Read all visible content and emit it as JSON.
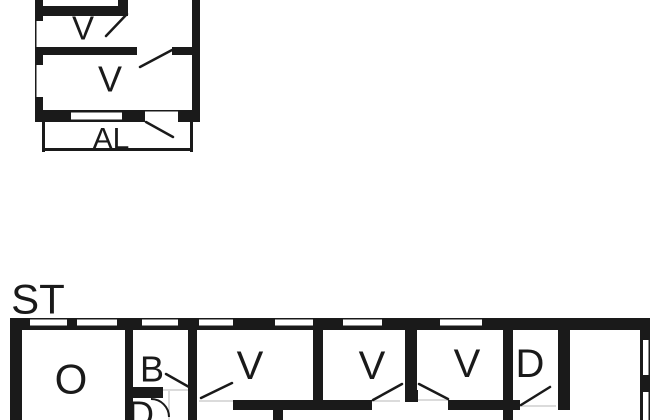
{
  "page": {
    "background": "#ffffff"
  },
  "floor_plan": {
    "type": "floor-plan",
    "canvas": {
      "width": 650,
      "height": 420
    },
    "colors": {
      "wall": "#1a1a1a",
      "floor": "#ffffff",
      "door_leaf": "#1a1a1a",
      "threshold": "#cfcfcf"
    },
    "buildings": [
      {
        "name": "upper-building",
        "room_labels": [
          "V",
          "V",
          "AL"
        ]
      },
      {
        "name": "lower-building",
        "annotation": "ST",
        "room_labels": [
          "O",
          "B",
          "D",
          "V",
          "V",
          "V",
          "D"
        ]
      }
    ],
    "labels": [
      {
        "text": "V",
        "x": 83,
        "y": 28,
        "size": 33,
        "name": "room-label-v-upper-small"
      },
      {
        "text": "V",
        "x": 110,
        "y": 79,
        "size": 36,
        "name": "room-label-v-upper-large"
      },
      {
        "text": "AL",
        "x": 111,
        "y": 139,
        "size": 30,
        "name": "room-label-al-balcony"
      },
      {
        "text": "ST",
        "x": 38,
        "y": 299,
        "size": 42,
        "name": "building-label-st"
      },
      {
        "text": "O",
        "x": 71,
        "y": 379,
        "size": 42,
        "name": "room-label-o"
      },
      {
        "text": "B",
        "x": 152,
        "y": 369,
        "size": 36,
        "name": "room-label-b"
      },
      {
        "text": "D",
        "x": 141,
        "y": 414,
        "size": 36,
        "name": "room-label-d-small"
      },
      {
        "text": "V",
        "x": 250,
        "y": 366,
        "size": 40,
        "name": "room-label-v1"
      },
      {
        "text": "V",
        "x": 372,
        "y": 366,
        "size": 40,
        "name": "room-label-v2"
      },
      {
        "text": "V",
        "x": 467,
        "y": 364,
        "size": 40,
        "name": "room-label-v3"
      },
      {
        "text": "D",
        "x": 530,
        "y": 364,
        "size": 40,
        "name": "room-label-d"
      }
    ],
    "walls": [
      [
        35,
        0,
        8,
        122
      ],
      [
        192,
        0,
        8,
        122
      ],
      [
        35,
        110,
        165,
        12
      ],
      [
        43,
        6,
        85,
        10
      ],
      [
        118,
        0,
        10,
        16
      ],
      [
        43,
        47,
        94,
        8
      ],
      [
        172,
        47,
        20,
        8
      ],
      [
        42,
        122,
        3,
        30
      ],
      [
        42,
        148,
        151,
        3
      ],
      [
        190,
        122,
        3,
        30
      ],
      [
        10,
        318,
        640,
        12
      ],
      [
        10,
        318,
        12,
        102
      ],
      [
        640,
        318,
        10,
        102
      ],
      [
        125,
        330,
        8,
        90
      ],
      [
        188,
        330,
        9,
        90
      ],
      [
        313,
        330,
        10,
        80
      ],
      [
        405,
        330,
        12,
        72
      ],
      [
        405,
        390,
        13,
        12
      ],
      [
        503,
        330,
        10,
        90
      ],
      [
        558,
        330,
        12,
        80
      ],
      [
        125,
        387,
        38,
        11
      ],
      [
        233,
        400,
        139,
        10
      ],
      [
        273,
        410,
        10,
        10
      ],
      [
        448,
        400,
        72,
        10
      ]
    ],
    "windows": [
      [
        36.5,
        21,
        6.5,
        26
      ],
      [
        36.5,
        65,
        6.5,
        32
      ],
      [
        71,
        112.5,
        51,
        7
      ],
      [
        145,
        111.5,
        33,
        10.5
      ],
      [
        137,
        49,
        35,
        6
      ],
      [
        30,
        319.5,
        37,
        6
      ],
      [
        77,
        319.5,
        40,
        6
      ],
      [
        142,
        319.5,
        36,
        6
      ],
      [
        199,
        319.5,
        34,
        6
      ],
      [
        275,
        319.5,
        38,
        6
      ],
      [
        343,
        319.5,
        39,
        6
      ],
      [
        440,
        319.5,
        42,
        6
      ],
      [
        643,
        340,
        5.5,
        35
      ],
      [
        643,
        392,
        5.5,
        28
      ]
    ],
    "door_leaves": [
      [
        106,
        36,
        127,
        14
      ],
      [
        172,
        50,
        140,
        67
      ],
      [
        146,
        122,
        173,
        137
      ],
      [
        189,
        387,
        166,
        374
      ],
      [
        201,
        398,
        232,
        383
      ],
      [
        373,
        400,
        402,
        384
      ],
      [
        448,
        399,
        419,
        384
      ],
      [
        521,
        405,
        550,
        387
      ]
    ],
    "thresholds": [
      [
        199,
        401,
        233,
        401
      ],
      [
        372,
        401,
        400,
        401
      ],
      [
        418,
        400,
        448,
        400
      ],
      [
        520,
        406,
        556,
        406
      ],
      [
        163,
        390,
        188,
        390
      ],
      [
        169,
        391,
        169,
        420
      ]
    ],
    "door_arcs": [
      {
        "d": "M 151,399 A 18 18 0 0 1 169,417"
      }
    ]
  }
}
